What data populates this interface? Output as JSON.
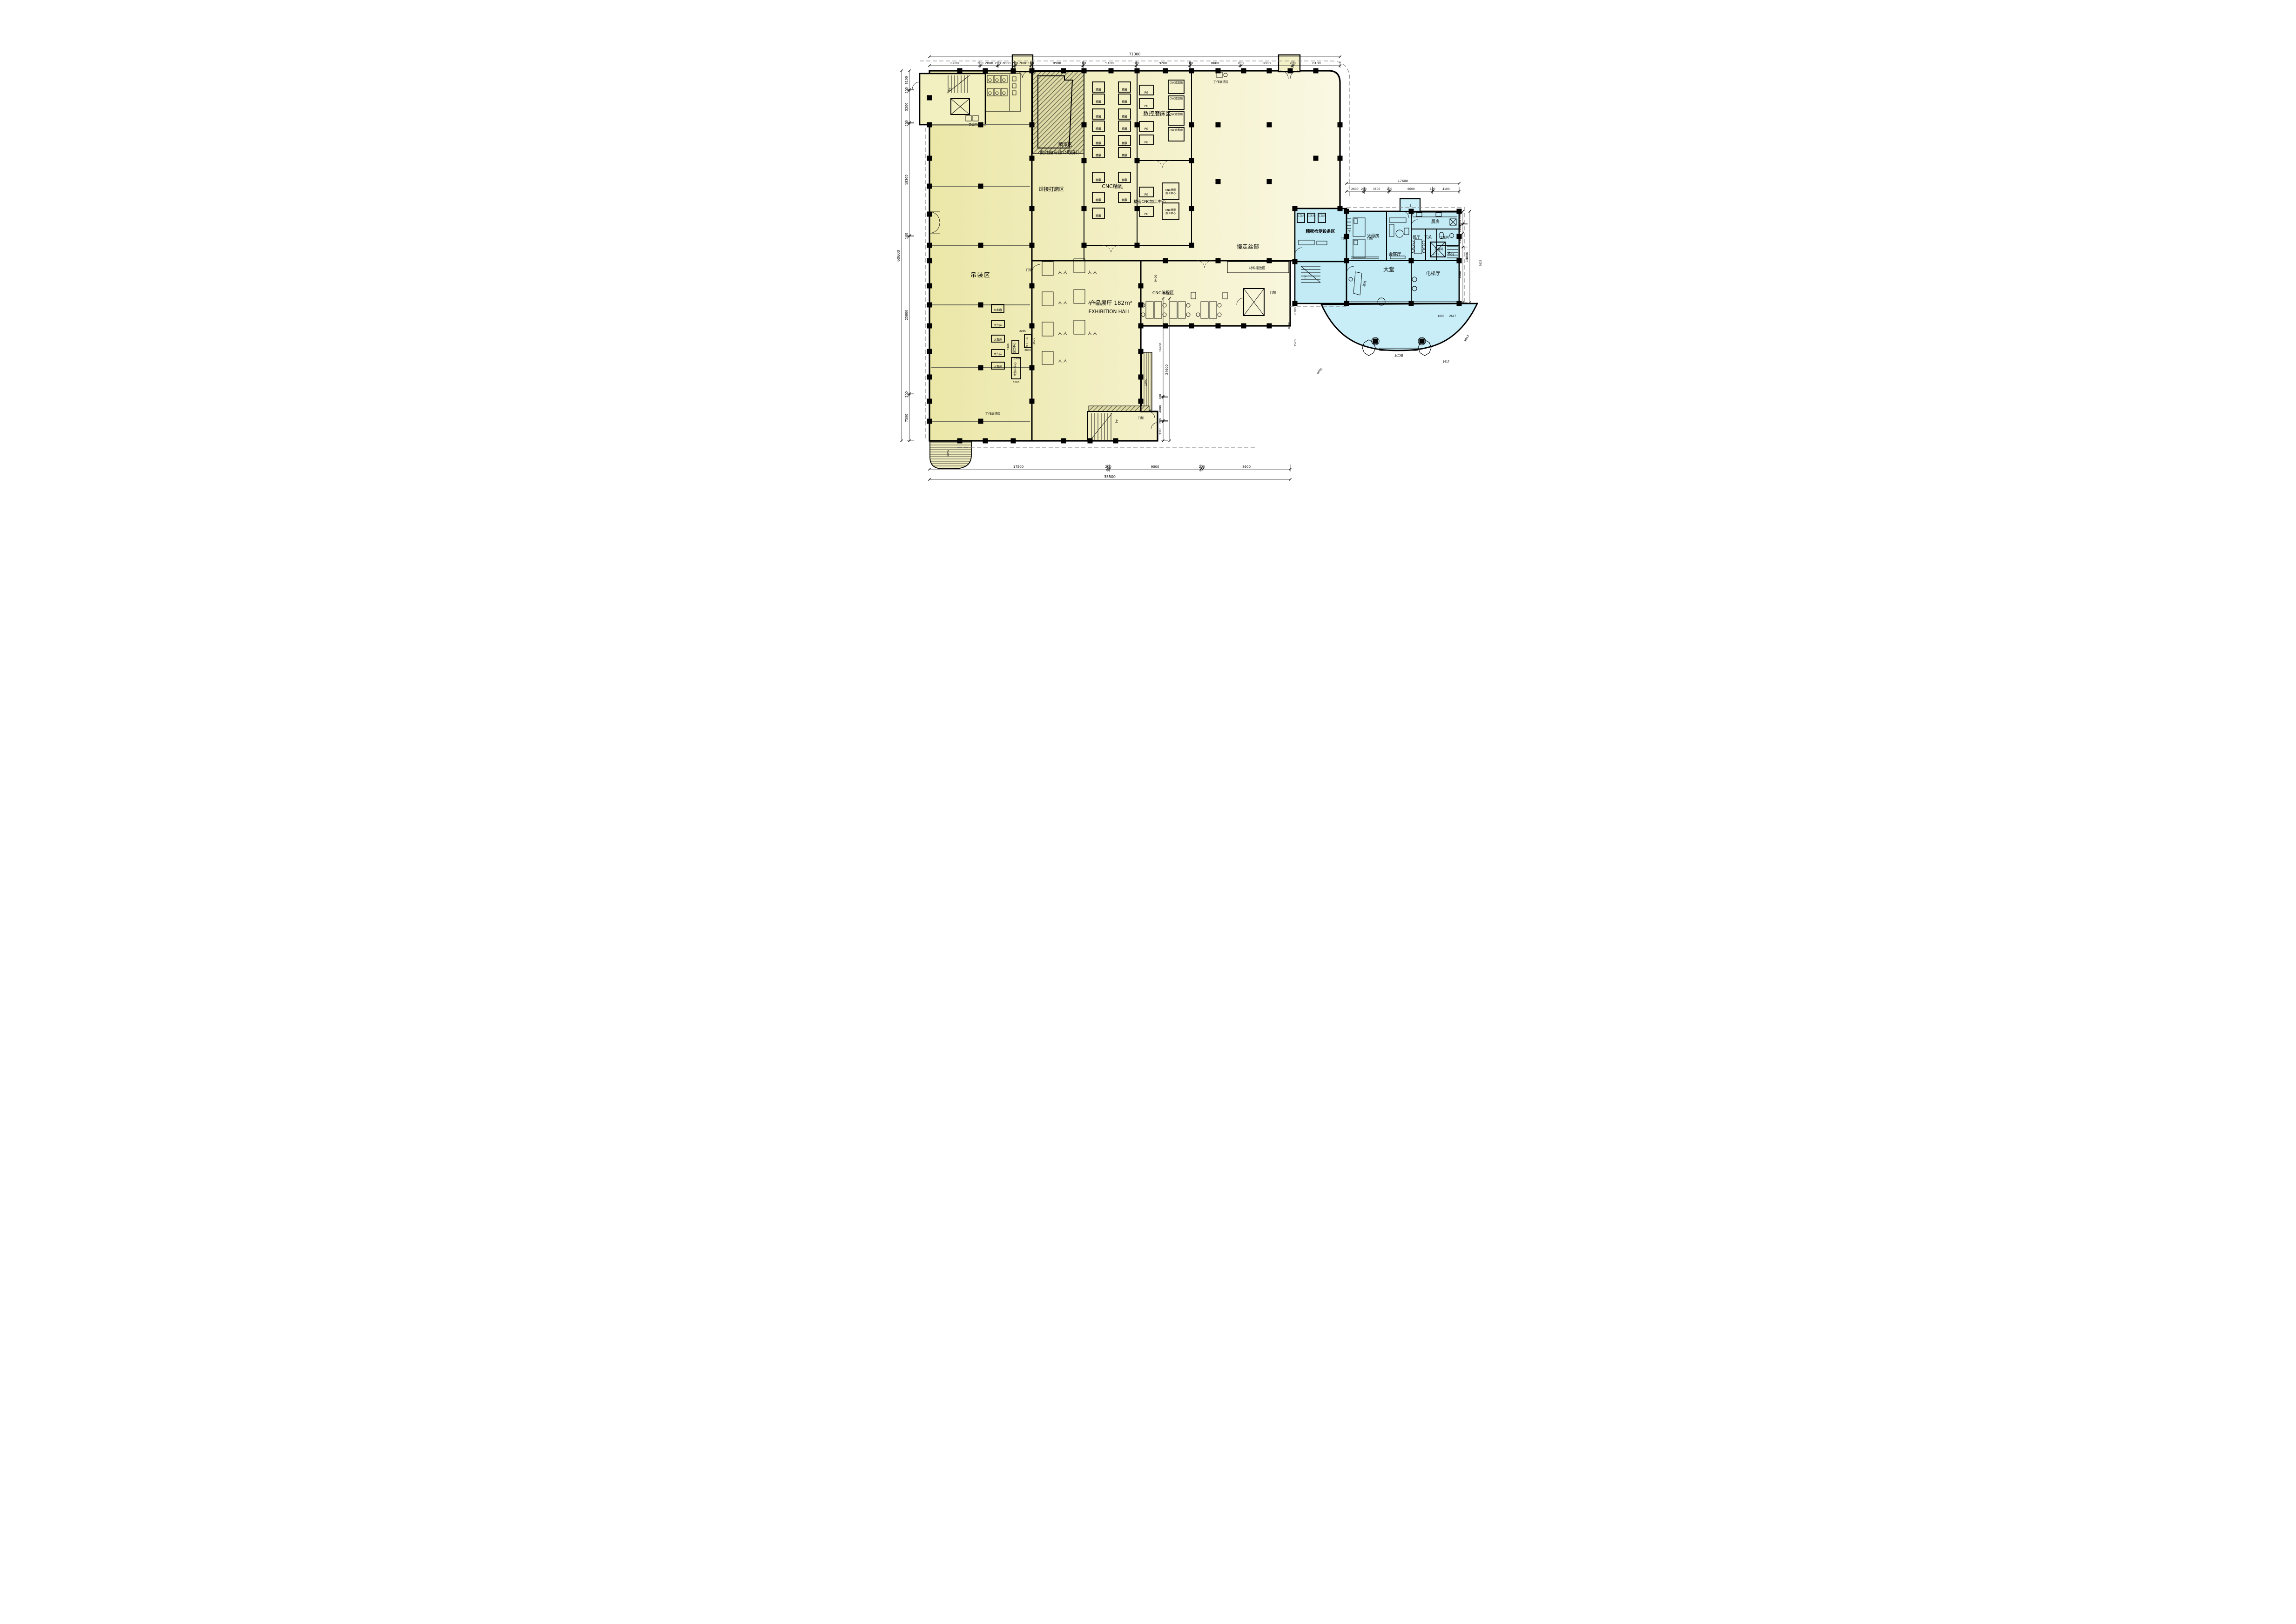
{
  "drawing": {
    "kind": "architectural-floor-plan",
    "language": "zh-CN"
  },
  "colors": {
    "factory_fill_left": "#ece8ab",
    "factory_fill_right": "#faf8e3",
    "residence_fill": "#c2ebf5",
    "canopy_fill": "#c9eef8",
    "wall": "#000000",
    "hatch_line": "#55553f",
    "dashed_guide": "#8a8a8a"
  },
  "zones": {
    "hoisting": "吊装区",
    "welding": "焊接打磨区",
    "paint": "喷漆区",
    "paint_note": "此处由专业公司设计",
    "cnc_engraving": "CNC精雕",
    "cnc_grinder": "数控磨床区",
    "precision_cnc": "精密CNC加工中心",
    "wire_edm": "慢走丝部",
    "material_staging": "材料摆放区",
    "cnc_programming": "CNC编程区",
    "exhibition_cn": "产品展厅 182m²",
    "exhibition_en": "EXHIBITION HALL",
    "inspection": "精密检测设备区",
    "lobby": "大堂",
    "front_desk": "前台",
    "elevator_hall": "电梯厅",
    "parents_room": "父母房",
    "reception_room": "会客厅",
    "dining_room": "餐厅",
    "foyer": "玄关",
    "bathroom": "卫生间",
    "kitchen": "厨房",
    "tool_room": "工具间",
    "chip_recycling": "铁屑回收",
    "work_cleaning": "工作清洁区"
  },
  "machines": {
    "engraver": "精雕",
    "pg": "PG",
    "cnc_form_grinder": "CNC成型磨",
    "cnc_precision_line1": "CNC精密",
    "cnc_precision_line2": "加工中心",
    "cmm": "三次元",
    "big_water_grinder": "大水磨",
    "big_lathe": "大车床",
    "machining_center": "加工中心",
    "big_machining_center": "大加工中心"
  },
  "annotations": {
    "up": "上",
    "down": "下",
    "access_control": "门禁",
    "ramp_slope": "10%",
    "up_two_steps": "上二级",
    "person": "人  人"
  },
  "dimensions": {
    "top": {
      "total": "71000",
      "segments": [
        "8700",
        "200",
        "2800",
        "200",
        "2800",
        "200",
        "2600",
        "100",
        "8900",
        "100",
        "9100",
        "100",
        "9200",
        "100",
        "8600",
        "200",
        "8800",
        "200",
        "8100"
      ]
    },
    "left": {
      "total": "60600",
      "segments": [
        "3100",
        "200",
        "5200",
        "200",
        "18300",
        "100",
        "25800",
        "200",
        "7500"
      ]
    },
    "bottom": {
      "total": "35500",
      "segments": [
        "17500",
        "200",
        "9000",
        "200",
        "8600"
      ]
    },
    "wing_top": {
      "total": "17600",
      "segments": [
        "2600",
        "200",
        "3800",
        "200",
        "6600",
        "100",
        "4100"
      ]
    },
    "wing_right": {
      "total": "14800",
      "segments": [
        "2000",
        "100",
        "1400",
        "2300",
        "9000"
      ]
    },
    "exhibition_right": {
      "total": "24600",
      "upper": "9400",
      "segments": [
        "16900",
        "200",
        "4000",
        "200",
        "3300"
      ]
    },
    "wing_bottom": [
      "4001",
      "2628"
    ],
    "canopy": [
      "7820",
      "6300",
      "1520",
      "6000",
      "5913",
      "1095",
      "2627",
      "1617"
    ],
    "machine_dims": [
      "2265",
      "2600",
      "2000",
      "3100",
      "2300",
      "3000",
      "2750"
    ]
  }
}
